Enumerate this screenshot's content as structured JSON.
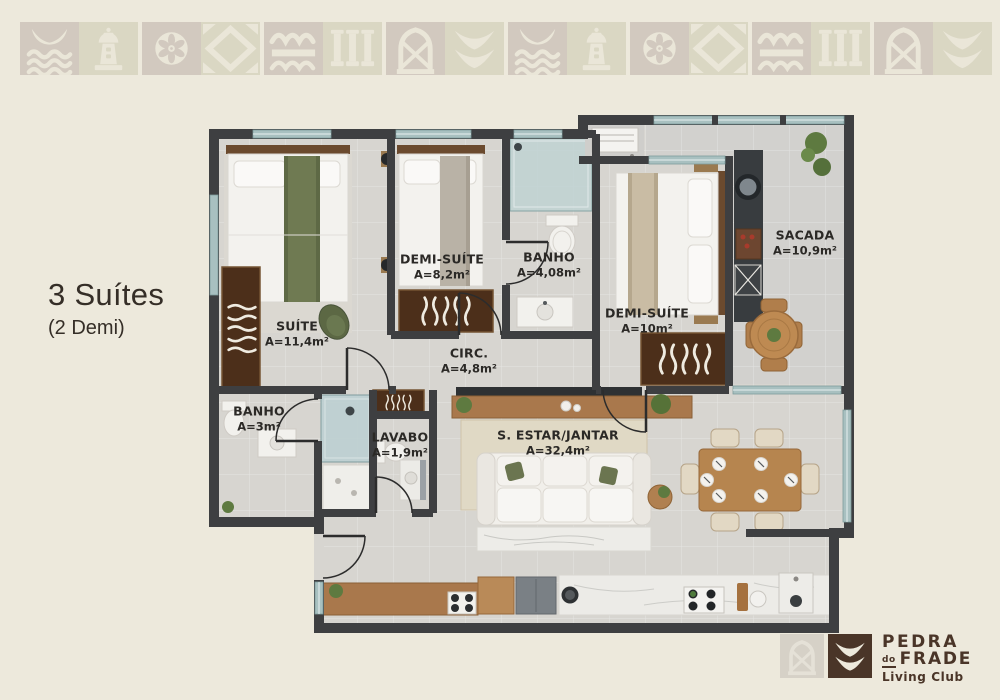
{
  "title_block": {
    "title": "3 Suítes",
    "subtitle": "(2 Demi)"
  },
  "plan": {
    "rooms": [
      {
        "name": "SUÍTE",
        "area": "A=11,4m²"
      },
      {
        "name": "DEMI-SUÍTE",
        "area": "A=8,2m²"
      },
      {
        "name": "BANHO",
        "area": "A=4,08m²"
      },
      {
        "name": "DEMI-SUÍTE",
        "area": "A=10m²"
      },
      {
        "name": "SACADA",
        "area": "A=10,9m²"
      },
      {
        "name": "CIRC.",
        "area": "A=4,8m²"
      },
      {
        "name": "BANHO",
        "area": "A=3m²"
      },
      {
        "name": "LAVABO",
        "area": "A=1,9m²"
      },
      {
        "name": "S. ESTAR/JANTAR",
        "area": "A=32,4m²"
      }
    ]
  },
  "logo": {
    "name_top": "PEDRA",
    "name_mid_small": "do",
    "name_mid": "FRADE",
    "tagline": "Living Club"
  },
  "colors": {
    "background": "#EDE9DC",
    "wall": "#3E3F41",
    "brand_brown": "#4A3528",
    "tile_taupe": "#D2C9BF",
    "tile_sage": "#DAD7C3",
    "glass": "#A8C0C0"
  }
}
